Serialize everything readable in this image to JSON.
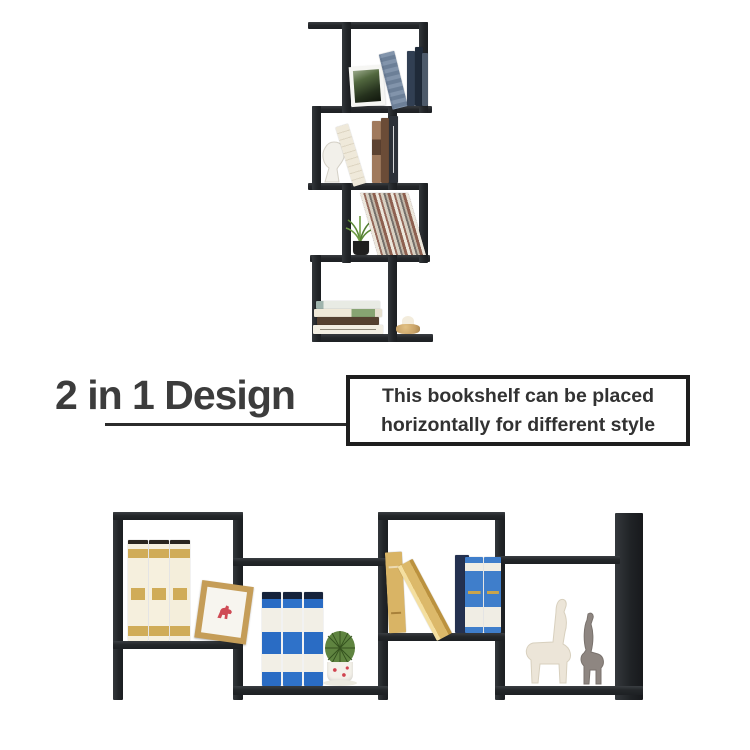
{
  "page": {
    "background": "#ffffff"
  },
  "heading": {
    "title": "2 in 1 Design",
    "color": "#3c3c3c"
  },
  "callout": {
    "line1": "This bookshelf can be placed",
    "line2": "horizontally for different style",
    "border_color": "#1e1e1e",
    "text_color": "#323232"
  },
  "connector": {
    "color": "#2b2b2b"
  },
  "palette": {
    "shelf_black": "#232629",
    "cream_book": "#f5efdd",
    "gold_book": "#d4ae5e",
    "blue_book": "#2a6cc4",
    "light_blue_book": "#3f7ecb",
    "plant_green": "#5d8a38",
    "wood_frame": "#c59d58",
    "figurine_white": "#ece5d8",
    "figurine_gray": "#8e8681",
    "dala_horse_red": "#cf4b55"
  },
  "vertical_shelf": {
    "name": "vertical-s-shaped-bookshelf",
    "tiers": [
      {
        "items": [
          "framed-plant-photo",
          "leaning-striped-book",
          "dark-books"
        ]
      },
      {
        "items": [
          "white-head-sculpture",
          "leaning-white-book",
          "brown-and-dark-books"
        ]
      },
      {
        "items": [
          "potted-grass-plant",
          "leaning-book-stack"
        ]
      },
      {
        "items": [
          "stacked-books",
          "round-candle-holder"
        ]
      }
    ]
  },
  "horizontal_shelf": {
    "name": "horizontal-s-shaped-bookshelf",
    "cells": [
      {
        "items": [
          "cream-gold-books",
          "dala-horse-picture-frame"
        ]
      },
      {
        "items": [
          "blue-books",
          "cactus-in-pot"
        ]
      },
      {
        "items": [
          "gold-books",
          "navy-book",
          "blue-white-books"
        ]
      },
      {
        "items": [
          "llama-figurine",
          "giraffe-figurine"
        ]
      }
    ]
  }
}
